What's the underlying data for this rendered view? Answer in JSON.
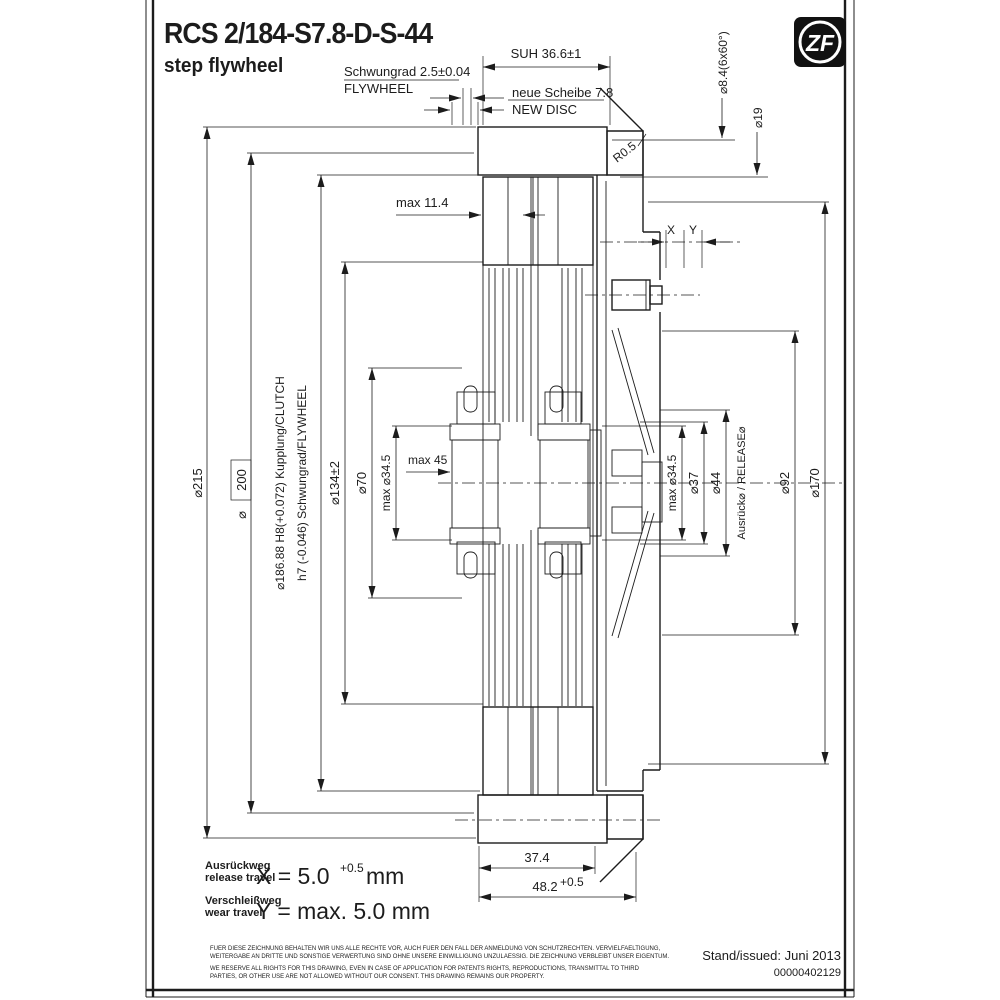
{
  "title": {
    "code": "RCS 2/184-S7.8-D-S-44",
    "subtitle": "step flywheel"
  },
  "logo_text": "ZF",
  "labels": {
    "suh": "SUH 36.6±1",
    "schwungrad": "Schwungrad 2.5±0.04",
    "flywheel": "FLYWHEEL",
    "neue_scheibe": "neue Scheibe 7.8",
    "new_disc": "NEW DISC",
    "holes": "⌀8.4(6x60°)",
    "d19": "⌀19",
    "r05": "R0.5",
    "max114": "max 11.4",
    "x": "X",
    "y": "Y",
    "d215": "⌀215",
    "phi": "⌀",
    "d200": "200",
    "d186_line": "⌀186.88 H8(+0.072)  Kupplung/CLUTCH",
    "h7_line": "h7 (-0.046)  Schwungrad/FLYWHEEL",
    "d134": "⌀134±2",
    "d70": "⌀70",
    "max_d345_left": "max ⌀34.5",
    "max45": "max 45",
    "max_d345_right": "max ⌀34.5",
    "d37": "⌀37",
    "d44": "⌀44",
    "release": "Ausrück⌀ / RELEASE⌀",
    "d92": "⌀92",
    "d170": "⌀170",
    "d374": "37.4",
    "d482": "48.2",
    "d482_tol": "+0.5"
  },
  "notes": {
    "release_de": "Ausrückweg",
    "release_en": "release travel",
    "x_eq": "X = 5.0",
    "x_tol": "+0.5",
    "x_unit": "mm",
    "wear_de": "Verschleißweg",
    "wear_en": "wear travel",
    "y_eq": "Y = max. 5.0 mm"
  },
  "footer": {
    "legal_de1": "FUER DIESE ZEICHNUNG BEHALTEN WIR UNS ALLE RECHTE VOR, AUCH FUER DEN FALL DER ANMELDUNG VON SCHUTZRECHTEN. VERVIELFAELTIGUNG,",
    "legal_de2": "WEITERGABE AN DRITTE UND SONSTIGE VERWERTUNG SIND OHNE UNSERE EINWILLIGUNG UNZULAESSIG. DIE ZEICHNUNG VERBLEIBT UNSER EIGENTUM.",
    "legal_en1": "WE RESERVE ALL RIGHTS FOR THIS DRAWING, EVEN IN CASE OF APPLICATION FOR PATENTS RIGHTS, REPRODUCTIONS, TRANSMITTAL TO THIRD",
    "legal_en2": "PARTIES, OR OTHER USE ARE NOT ALLOWED WITHOUT OUR CONSENT. THIS DRAWING REMAINS OUR PROPERTY.",
    "issued": "Stand/issued: Juni 2013",
    "number": "00000402129"
  }
}
